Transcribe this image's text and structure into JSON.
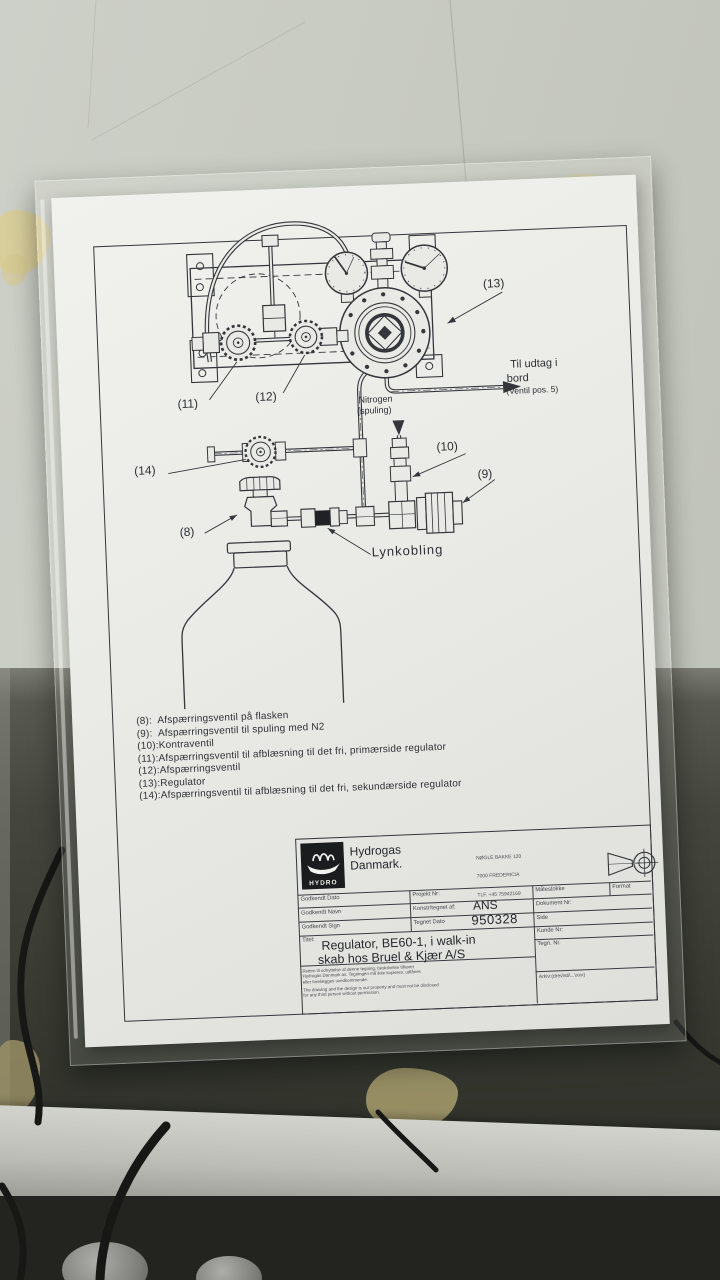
{
  "photo": {
    "wall_color": "#c7cac0",
    "shadow_area_color": "#3c3e36",
    "ledge_color": "#b9bab4",
    "tape_color": "#d6c994"
  },
  "drawing": {
    "callouts": {
      "v8": "(8)",
      "v9": "(9)",
      "v10": "(10)",
      "v11": "(11)",
      "v12": "(12)",
      "v13": "(13)",
      "v14": "(14)"
    },
    "labels": {
      "outlet_1": "Til udtag i",
      "outlet_2": "bord",
      "outlet_3": "(Ventil pos. 5)",
      "nitrogen_1": "Nitrogen",
      "nitrogen_2": "(spuling)",
      "quick_coupling": "Lynkobling"
    },
    "legend": [
      "(8):  Afspærringsventil på flasken",
      "(9):  Afspærringsventil til spuling med N2",
      "(10):Kontraventil",
      "(11):Afspærringsventil til afblæsning til det fri, primærside regulator",
      "(12):Afspærringsventil",
      "(13):Regulator",
      "(14):Afspærringsventil til afblæsning til det fri, sekundærside regulator"
    ],
    "title_block": {
      "company_1": "Hydrogas",
      "company_2": "Danmark.",
      "logo_text": "HYDRO",
      "address_1": "NØGLE BAKKE 120",
      "address_2": "7000 FREDERICIA",
      "address_3": "TLF. +45 75942169",
      "approved_date_label": "Godkendt Dato",
      "approved_name_label": "Godkendt Navn",
      "approved_sign_label": "Godkendt Sign",
      "project_no_label": "Projekt Nr:",
      "drawn_by_label": "Konstr/tegnet af:",
      "drawn_by_value": "ANS",
      "drawn_date_label": "Tegnet Dato",
      "drawn_date_value": "950328",
      "scale_label": "Målestokke",
      "format_label": "Format",
      "document_no_label": "Dokument Nr:",
      "page_label": "Side",
      "customer_no_label": "Kunde Nr:",
      "drawing_no_label": "Tegn. Nr.",
      "title_label": "Titel:",
      "title_1": "Regulator, BE60-1, i walk-in",
      "title_2": "skab hos Bruel & Kjær A/S",
      "archive_label": "Arkiv:(drev\\sti\\...\\xxx)",
      "disclaimer_da_1": "Retten til udnyttelse af denne tegning, beskrivelse tilhører",
      "disclaimer_da_2": "Hydrogas Danmark as. Tegningen må ikke kopieres, udlånes",
      "disclaimer_da_3": "eller forelægges uvedkommende.",
      "disclaimer_en_1": "The drawing and the design is our property and must not be disclosed",
      "disclaimer_en_2": "for any third person without permission."
    }
  }
}
